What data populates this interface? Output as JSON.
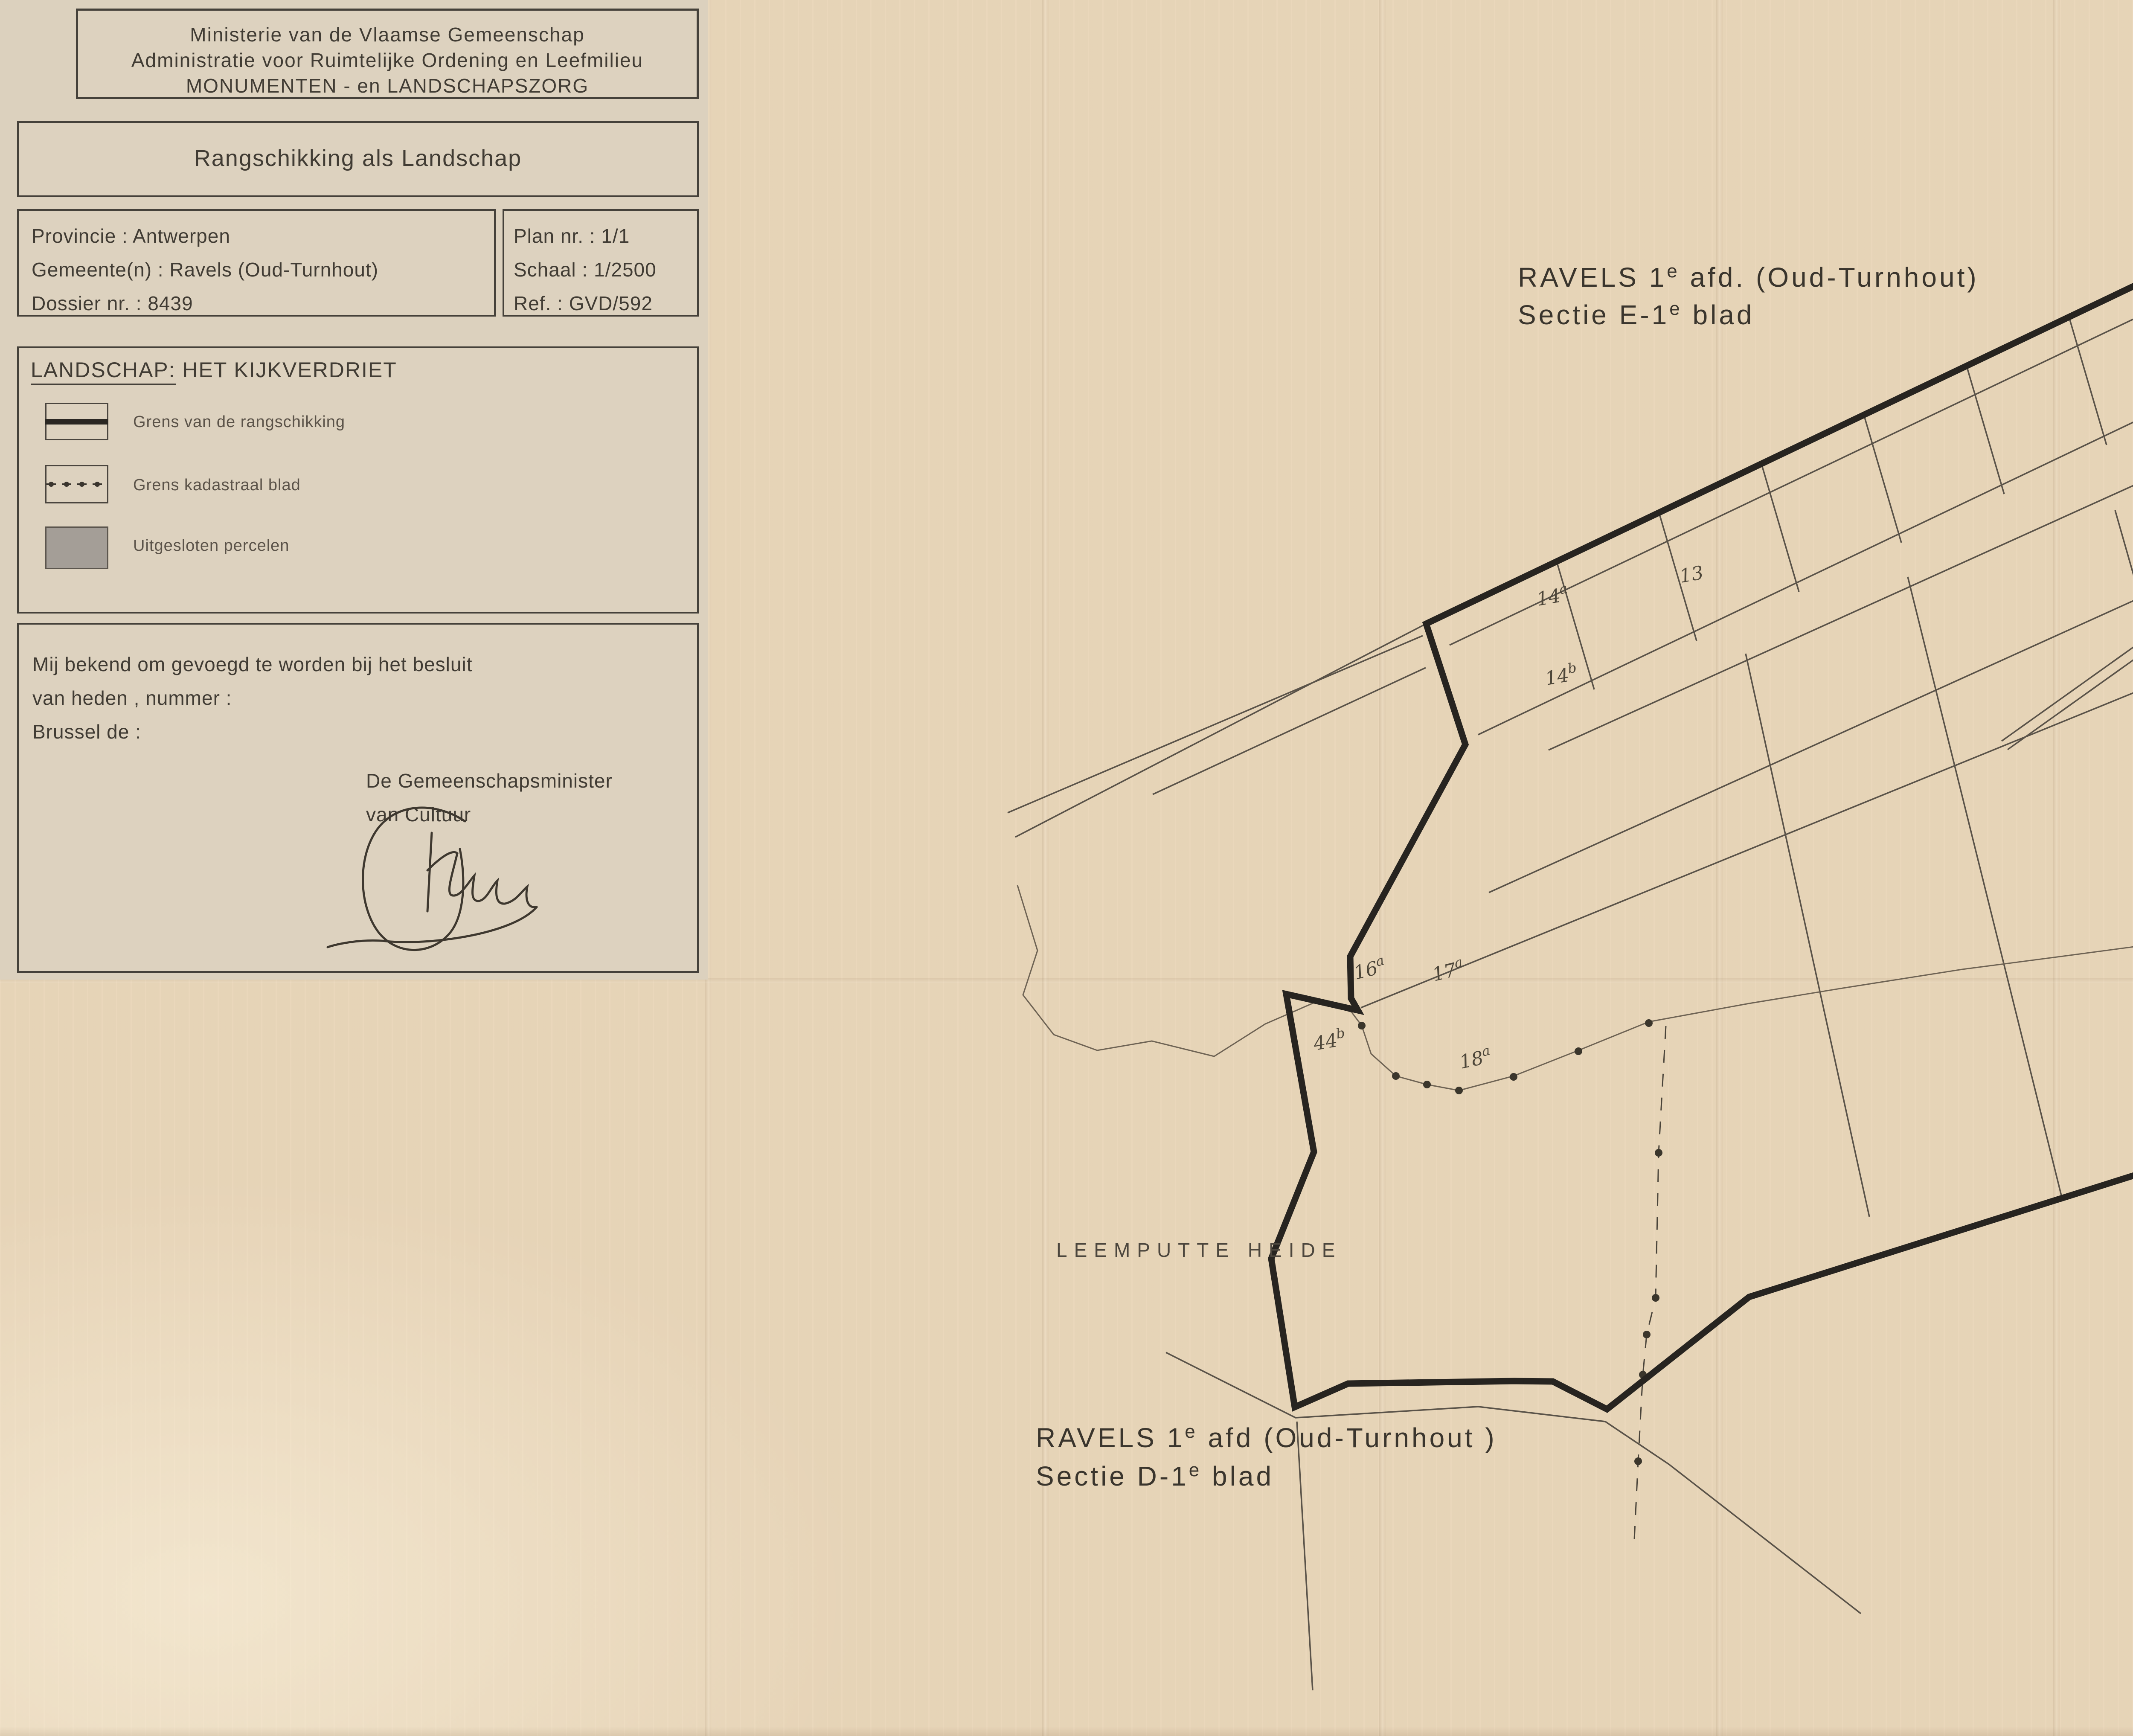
{
  "panel": {
    "ministry": {
      "line1": "Ministerie van de Vlaamse Gemeenschap",
      "line2": "Administratie voor Ruimtelijke Ordening en Leefmilieu",
      "line3": "MONUMENTEN - en LANDSCHAPSZORG"
    },
    "title_block": {
      "title": "Rangschikking als Landschap"
    },
    "info_block": {
      "province": "Provincie : Antwerpen",
      "municipality": "Gemeente(n) : Ravels (Oud-Turnhout)",
      "dossier": "Dossier nr. : 8439",
      "plan": "Plan nr. : 1/1",
      "scale": "Schaal : 1/2500",
      "ref": "Ref. : GVD/592"
    },
    "legend": {
      "title_underlined": "LANDSCHAP:",
      "title_rest": " HET KIJKVERDRIET",
      "items": [
        {
          "symbol": "thick-line",
          "label": "Grens van de rangschikking"
        },
        {
          "symbol": "dash-dot-line",
          "label": "Grens kadastraal blad"
        },
        {
          "symbol": "gray-fill",
          "label": "Uitgesloten percelen"
        }
      ]
    },
    "statement": {
      "line1": "Mij bekend om gevoegd te worden bij het besluit",
      "line2": "van heden , nummer :",
      "line3": "Brussel de :",
      "signatory_line1": "De Gemeenschapsminister",
      "signatory_line2": "van Cultuur"
    }
  },
  "map": {
    "section_e": {
      "pre": "RAVELS 1",
      "sup": "e",
      "post": " afd. (Oud-Turnhout)",
      "line2_pre": "Sectie E-1",
      "line2_sup": "e",
      "line2_post": " blad"
    },
    "section_d": {
      "pre": "RAVELS 1",
      "sup": "e",
      "post": " afd (Oud-Turnhout )",
      "line2_pre": "Sectie D-1",
      "line2_sup": "e",
      "line2_post": " blad"
    },
    "place_labels": {
      "hoogemierdsche": "HOOGEMIERDSCHE",
      "leemputte": "LEEMPUTTE HEIDE"
    },
    "north_label": "N",
    "parcel_labels": [
      {
        "n": "14",
        "s": "a"
      },
      {
        "n": "14",
        "s": "b"
      },
      {
        "n": "13",
        "s": ""
      },
      {
        "n": "16",
        "s": "a"
      },
      {
        "n": "17",
        "s": "a"
      },
      {
        "n": "18",
        "s": "a"
      },
      {
        "n": "44",
        "s": "b"
      },
      {
        "n": "31",
        "s": "f"
      },
      {
        "n": "31",
        "s": "e"
      },
      {
        "n": "11",
        "s": "a"
      },
      {
        "n": "38",
        "s": "b"
      },
      {
        "n": "36",
        "s": ""
      }
    ]
  },
  "colors": {
    "paper": "#e9d6b9",
    "panel_paper": "#ddd2bf",
    "ink": "#3f3a33",
    "boundary": "#272420",
    "thin_line": "#564f45",
    "excluded_fill": "#a49e97"
  }
}
